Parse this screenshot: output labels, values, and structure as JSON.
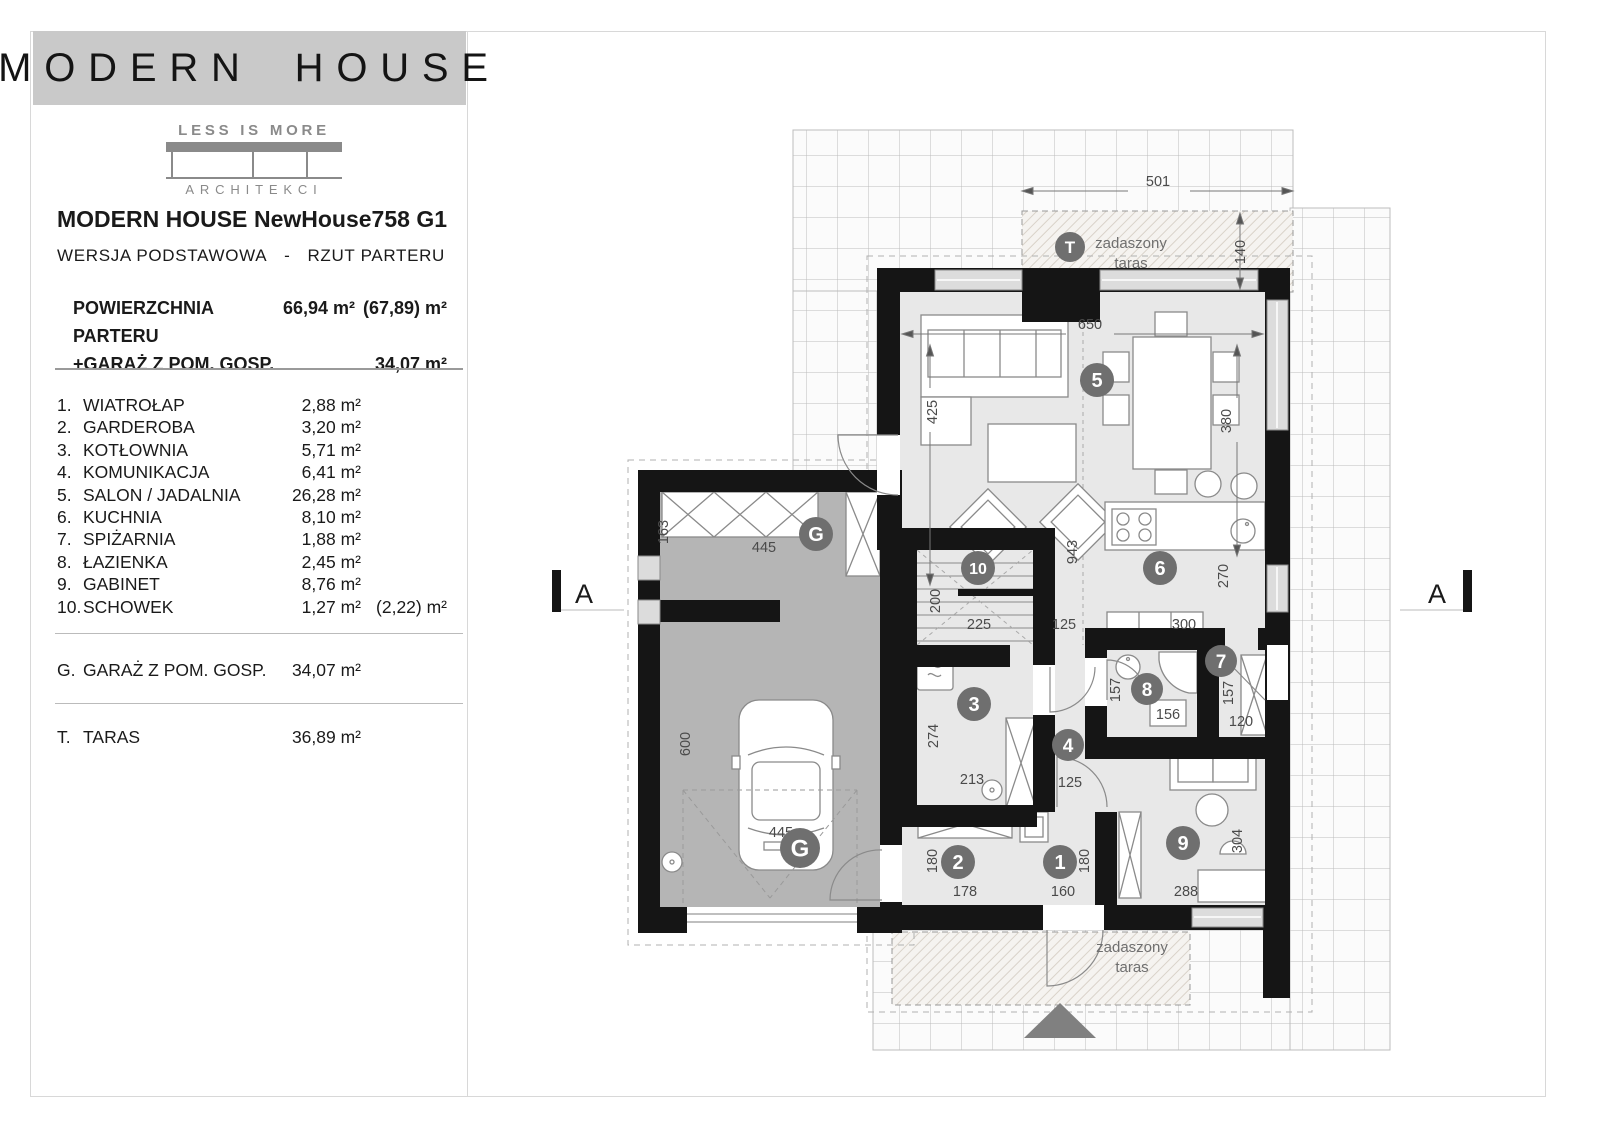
{
  "brand": {
    "banner": "MODERN HOUSE",
    "logo_top": "LESS IS MORE",
    "logo_bottom": "ARCHITEKCI"
  },
  "header": {
    "title_left": "MODERN HOUSE",
    "title_right": "NewHouse758 G1",
    "version": "WERSJA PODSTAWOWA",
    "dash": "-",
    "view": "RZUT PARTERU"
  },
  "areas": {
    "row1_label": "POWIERZCHNIA PARTERU",
    "row1_value": "66,94 m²",
    "row1_extra": "(67,89) m²",
    "row2_label": "+GARAŻ Z POM. GOSP.",
    "row2_value": "34,07 m²"
  },
  "rooms": [
    {
      "no": "1.",
      "name": "WIATROŁAP",
      "area": "2,88 m²",
      "extra": ""
    },
    {
      "no": "2.",
      "name": "GARDEROBA",
      "area": "3,20 m²",
      "extra": ""
    },
    {
      "no": "3.",
      "name": "KOTŁOWNIA",
      "area": "5,71 m²",
      "extra": ""
    },
    {
      "no": "4.",
      "name": "KOMUNIKACJA",
      "area": "6,41 m²",
      "extra": ""
    },
    {
      "no": "5.",
      "name": "SALON / JADALNIA",
      "area": "26,28 m²",
      "extra": ""
    },
    {
      "no": "6.",
      "name": "KUCHNIA",
      "area": "8,10 m²",
      "extra": ""
    },
    {
      "no": "7.",
      "name": "SPIŻARNIA",
      "area": "1,88 m²",
      "extra": ""
    },
    {
      "no": "8.",
      "name": "ŁAZIENKA",
      "area": "2,45 m²",
      "extra": ""
    },
    {
      "no": "9.",
      "name": "GABINET",
      "area": "8,76 m²",
      "extra": ""
    },
    {
      "no": "10.",
      "name": "SCHOWEK",
      "area": "1,27 m²",
      "extra": "(2,22) m²"
    }
  ],
  "garage_row": {
    "no": "G.",
    "name": "GARAŻ Z POM. GOSP.",
    "area": "34,07 m²"
  },
  "terrace_row": {
    "no": "T.",
    "name": "TARAS",
    "area": "36,89 m²"
  },
  "plan": {
    "section_letter": "A",
    "sections": [
      {
        "x": 584,
        "y": 603
      },
      {
        "x": 1437,
        "y": 603
      }
    ],
    "labels": [
      {
        "t": "zadaszony",
        "x": 1131,
        "y": 248,
        "fs": 15
      },
      {
        "t": "taras",
        "x": 1131,
        "y": 268,
        "fs": 15
      },
      {
        "t": "zadaszony",
        "x": 1132,
        "y": 952,
        "fs": 15
      },
      {
        "t": "taras",
        "x": 1132,
        "y": 972,
        "fs": 15
      }
    ],
    "badges": [
      {
        "t": "T",
        "x": 1070,
        "y": 247,
        "r": 15,
        "fs": 17
      },
      {
        "t": "5",
        "x": 1097,
        "y": 380,
        "r": 17,
        "fs": 20
      },
      {
        "t": "G",
        "x": 816,
        "y": 534,
        "r": 17,
        "fs": 20
      },
      {
        "t": "G",
        "x": 800,
        "y": 848,
        "r": 20,
        "fs": 24
      },
      {
        "t": "10",
        "x": 978,
        "y": 568,
        "r": 17,
        "fs": 16
      },
      {
        "t": "6",
        "x": 1160,
        "y": 568,
        "r": 17,
        "fs": 20
      },
      {
        "t": "3",
        "x": 974,
        "y": 704,
        "r": 17,
        "fs": 20
      },
      {
        "t": "4",
        "x": 1068,
        "y": 745,
        "r": 16,
        "fs": 19
      },
      {
        "t": "8",
        "x": 1147,
        "y": 689,
        "r": 16,
        "fs": 19
      },
      {
        "t": "7",
        "x": 1221,
        "y": 661,
        "r": 16,
        "fs": 19
      },
      {
        "t": "9",
        "x": 1183,
        "y": 843,
        "r": 17,
        "fs": 20
      },
      {
        "t": "2",
        "x": 958,
        "y": 862,
        "r": 17,
        "fs": 20
      },
      {
        "t": "1",
        "x": 1060,
        "y": 862,
        "r": 17,
        "fs": 20
      }
    ],
    "dims": [
      {
        "t": "501",
        "x": 1158,
        "y": 186,
        "rot": 0
      },
      {
        "t": "140",
        "x": 1245,
        "y": 252,
        "rot": 1
      },
      {
        "t": "650",
        "x": 1090,
        "y": 329,
        "rot": 0
      },
      {
        "t": "425",
        "x": 937,
        "y": 412,
        "rot": 1
      },
      {
        "t": "380",
        "x": 1231,
        "y": 421,
        "rot": 1
      },
      {
        "t": "943",
        "x": 1077,
        "y": 552,
        "rot": 1
      },
      {
        "t": "270",
        "x": 1228,
        "y": 576,
        "rot": 1
      },
      {
        "t": "163",
        "x": 668,
        "y": 532,
        "rot": 1
      },
      {
        "t": "445",
        "x": 764,
        "y": 552,
        "rot": 0
      },
      {
        "t": "200",
        "x": 940,
        "y": 601,
        "rot": 1
      },
      {
        "t": "225",
        "x": 979,
        "y": 629,
        "rot": 0
      },
      {
        "t": "125",
        "x": 1064,
        "y": 629,
        "rot": 0
      },
      {
        "t": "300",
        "x": 1184,
        "y": 629,
        "rot": 0
      },
      {
        "t": "157",
        "x": 1120,
        "y": 690,
        "rot": 1
      },
      {
        "t": "156",
        "x": 1168,
        "y": 719,
        "rot": 0
      },
      {
        "t": "157",
        "x": 1233,
        "y": 693,
        "rot": 1
      },
      {
        "t": "120",
        "x": 1241,
        "y": 726,
        "rot": 0
      },
      {
        "t": "274",
        "x": 938,
        "y": 736,
        "rot": 1
      },
      {
        "t": "213",
        "x": 972,
        "y": 784,
        "rot": 0
      },
      {
        "t": "125",
        "x": 1070,
        "y": 787,
        "rot": 0
      },
      {
        "t": "600",
        "x": 690,
        "y": 744,
        "rot": 1
      },
      {
        "t": "445",
        "x": 781,
        "y": 837,
        "rot": 0
      },
      {
        "t": "180",
        "x": 937,
        "y": 861,
        "rot": 1
      },
      {
        "t": "178",
        "x": 965,
        "y": 896,
        "rot": 0
      },
      {
        "t": "180",
        "x": 1089,
        "y": 861,
        "rot": 1
      },
      {
        "t": "160",
        "x": 1063,
        "y": 896,
        "rot": 0
      },
      {
        "t": "288",
        "x": 1186,
        "y": 896,
        "rot": 0
      },
      {
        "t": "304",
        "x": 1242,
        "y": 841,
        "rot": 1
      }
    ]
  },
  "colors": {
    "wall": "#151515",
    "room_fill": "#e8e8e8",
    "garage_fill": "#b5b5b5",
    "badge": "#6f6f6f",
    "grid_line": "#bdbdbd",
    "banner": "#c9c9c9",
    "logo": "#8a8a8a"
  }
}
